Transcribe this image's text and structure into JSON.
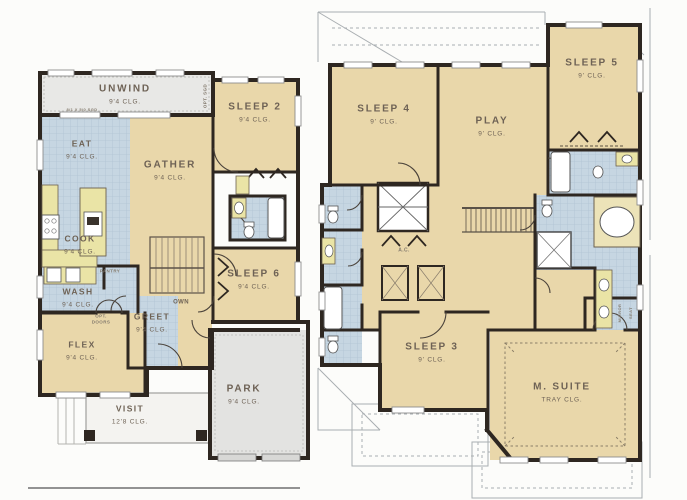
{
  "colors": {
    "room_fill": "#e9d7aa",
    "tile_fill": "#c6d6e2",
    "porch_fill": "#e4e4e2",
    "wall": "#2e2721",
    "counter": "#eae4a6",
    "label_text": "#6e6255",
    "roof_line": "#a9aeb1"
  },
  "first_floor": {
    "rooms": {
      "unwind": {
        "name": "UNWIND",
        "clg": "9'4 CLG."
      },
      "sleep2": {
        "name": "SLEEP 2",
        "clg": "9'4 CLG."
      },
      "eat": {
        "name": "EAT",
        "clg": "9'4 CLG."
      },
      "gather": {
        "name": "GATHER",
        "clg": "9'4 CLG."
      },
      "cook": {
        "name": "COOK",
        "clg": "9'4 CLG."
      },
      "sleep6": {
        "name": "SLEEP 6",
        "clg": "9'4 CLG."
      },
      "wash": {
        "name": "WASH",
        "clg": "9'4 CLG."
      },
      "greet": {
        "name": "GREET",
        "clg": "9'4 CLG."
      },
      "flex": {
        "name": "FLEX",
        "clg": "9'4 CLG."
      },
      "visit": {
        "name": "VISIT",
        "clg": "12'8 CLG."
      },
      "park": {
        "name": "PARK",
        "clg": "9'4 CLG."
      }
    },
    "annotations": {
      "own": "OWN",
      "pantry": "PANTRY",
      "opt_doors_line1": "OPT.",
      "opt_doors_line2": "DOORS",
      "opt_sgd": "OPT. SGD",
      "sgd_spec": "8/1 X 5/0 SGD"
    }
  },
  "second_floor": {
    "rooms": {
      "sleep4": {
        "name": "SLEEP 4",
        "clg": "9' CLG."
      },
      "play": {
        "name": "PLAY",
        "clg": "9' CLG."
      },
      "sleep5": {
        "name": "SLEEP 5",
        "clg": "9' CLG."
      },
      "sleep3": {
        "name": "SLEEP 3",
        "clg": "9' CLG."
      },
      "msuite": {
        "name": "M. SUITE",
        "clg": "TRAY CLG."
      }
    },
    "annotations": {
      "ac": "A.C.",
      "mirror": "MIRROR",
      "seat": "SEAT"
    }
  }
}
